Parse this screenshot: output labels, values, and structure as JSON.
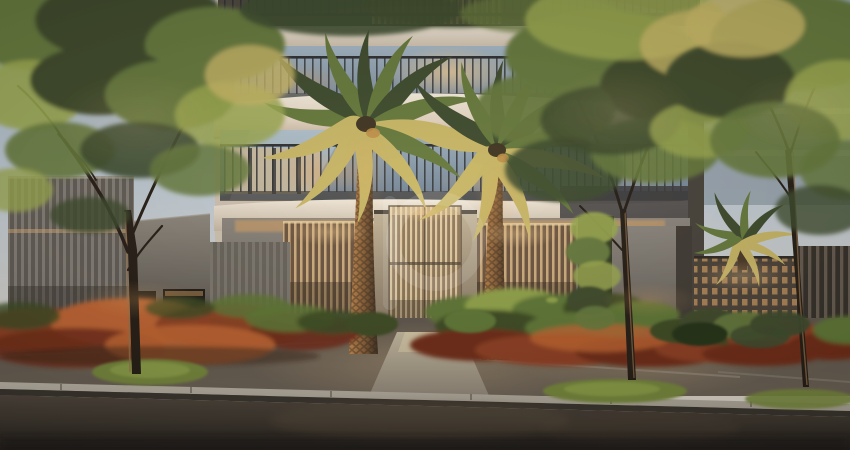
{
  "image": {
    "kind": "architectural-rendering",
    "subject": "Street-level dusk view of a modern residential building entrance: slatted wood gate flanked by louvered screens, two tall palm trees, street trees, orange and green planted beds, sidewalk, curb and asphalt road",
    "time_of_day": "dusk",
    "visible_text": "none"
  },
  "watermark": {
    "present": true,
    "shape": "translucent ring with vertical stem (b-like logo)",
    "color": "#ffffff",
    "opacity": 0.12,
    "position": "center"
  },
  "palette": {
    "sky_top": "#9db1c4",
    "sky_mid": "#c2ccd5",
    "sky_low": "#dcd6cc",
    "slab_light": "#f2e9da",
    "slab_dark": "#c7b8a5",
    "glass_blue": "#a4b7c6",
    "glass_deep": "#7b8c9d",
    "glow_warm": "#f0cb92",
    "glow_amber": "#e3a660",
    "railing": "#2c2e32",
    "screen_light": "#cfae80",
    "screen_dark": "#6b5440",
    "gate_light": "#e0c9a2",
    "gate_dark": "#7e6950",
    "wall_gray": "#8a857e",
    "wall_gray_dark": "#5f5a54",
    "slot_dark": "#232019",
    "cobogo_base": "#4a4138",
    "cobogo_hole": "#bc8f5c",
    "fence_dark": "#332e28",
    "trunk_light": "#c68a50",
    "trunk_dark": "#3c2d20",
    "leaf_dark": "#3c4a2c",
    "leaf_mid": "#65793c",
    "leaf_bright": "#9aa84f",
    "leaf_gold": "#c9b866",
    "bed_orange": "#c06430",
    "bed_rust": "#8d3e20",
    "bed_deep": "#6e2a16",
    "fern": "#5d7634",
    "fern_dark": "#3a4a22",
    "fern_bright": "#8fa34a",
    "grass": "#75873a",
    "sidewalk": "#6a6054",
    "walk_light": "#c2b89f",
    "curb": "#a9a295",
    "road": "#3a342c",
    "road_dark": "#221f1b",
    "tree_bark": "#231c15",
    "bark_lit": "#96714a",
    "watermark_color": "#ffffff"
  }
}
